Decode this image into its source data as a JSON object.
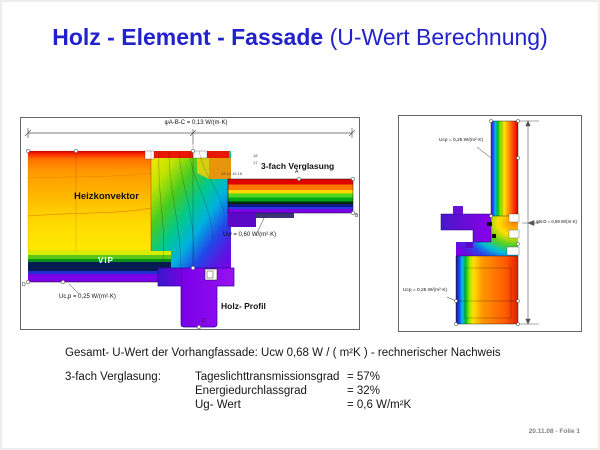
{
  "slide": {
    "title_bold": "Holz - Element - Fassade",
    "title_regular": " (U-Wert Berechnung)",
    "footer": "20.11.08 - Folie 1"
  },
  "left_diagram": {
    "psi_top": "ψA-B-C = 0,13 W/(m·K)",
    "label_heizkonvektor": "Heizkonvektor",
    "label_vip": "VIP",
    "label_verglasung": "3-fach Verglasung",
    "label_holz_profil": "Holz- Profil",
    "u_glazing": "Uw = 0,60 W/(m²·K)",
    "u_panel": "Uc,p = 0,25 W/(m²·K)",
    "iso_row": "13 14 15  16",
    "iso_17": "17",
    "iso_18": "18",
    "marker_a": "A",
    "marker_b": "B",
    "marker_c": "C",
    "marker_d": "D"
  },
  "right_diagram": {
    "u_top": "Ucp = 0,25 W/(m²·K)",
    "psi_right": "ψB-D = 0,59 W/(m·K)",
    "u_bottom": "Ucp = 0,25 W/(m²·K)"
  },
  "summary": {
    "line1": "Gesamt- U-Wert der Vorhangfassade: Ucw 0,68 W / ( m²K )  -  rechnerischer Nachweis",
    "glazing_label": "3-fach Verglasung:",
    "rows": [
      {
        "name": "Tageslichttransmissionsgrad",
        "value": "= 57%"
      },
      {
        "name": "Energiedurchlassgrad",
        "value": "= 32%"
      },
      {
        "name": "Ug- Wert",
        "value": "= 0,6 W/m²K"
      }
    ]
  },
  "colors": {
    "title": "#2222cc",
    "footer": "#808080",
    "thermal_palette": [
      "#e00000",
      "#ff8000",
      "#ffe000",
      "#00c820",
      "#00b8e8",
      "#2040f0",
      "#7a00e8"
    ]
  }
}
